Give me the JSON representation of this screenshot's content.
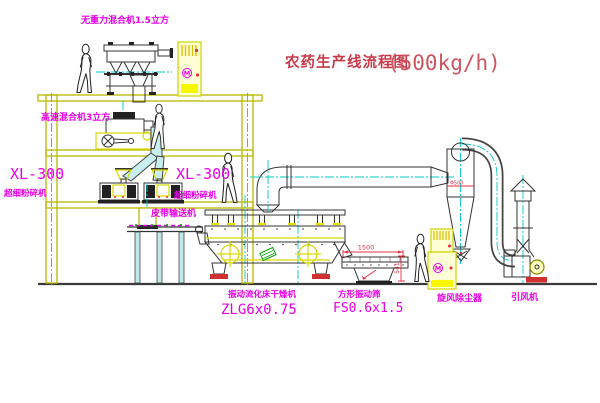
{
  "title": {
    "main": "农药生产线流程图",
    "capacity": "(500kg/h)"
  },
  "labels": {
    "top_mixer": "无重力混合机1.5立方",
    "high_speed_mixer": "高速混合机3立方",
    "mill_left_model": "XL-300",
    "mill_left_name": "超细粉碎机",
    "mill_center_model": "XL-300",
    "mill_center_name": "超细粉碎机",
    "belt_conveyor": "皮带输送机",
    "dryer_name": "振动流化床干燥机",
    "dryer_model": "ZLG6x0.75",
    "screen_name": "方形振动筛",
    "screen_model": "FS0.6x1.5",
    "cyclone": "旋风除尘器",
    "fan": "引风机"
  },
  "dimensions": {
    "screen_length": "1500",
    "screen_height": "541",
    "cyclone_diameter": "Φ500"
  },
  "symbols": {
    "motor": "M"
  },
  "colors": {
    "label_magenta": "#e800e8",
    "title_red": "#c9394a",
    "frame_yellow": "#b8b800",
    "centerline_cyan": "#00c8c8",
    "dimension_red": "#e03040"
  }
}
